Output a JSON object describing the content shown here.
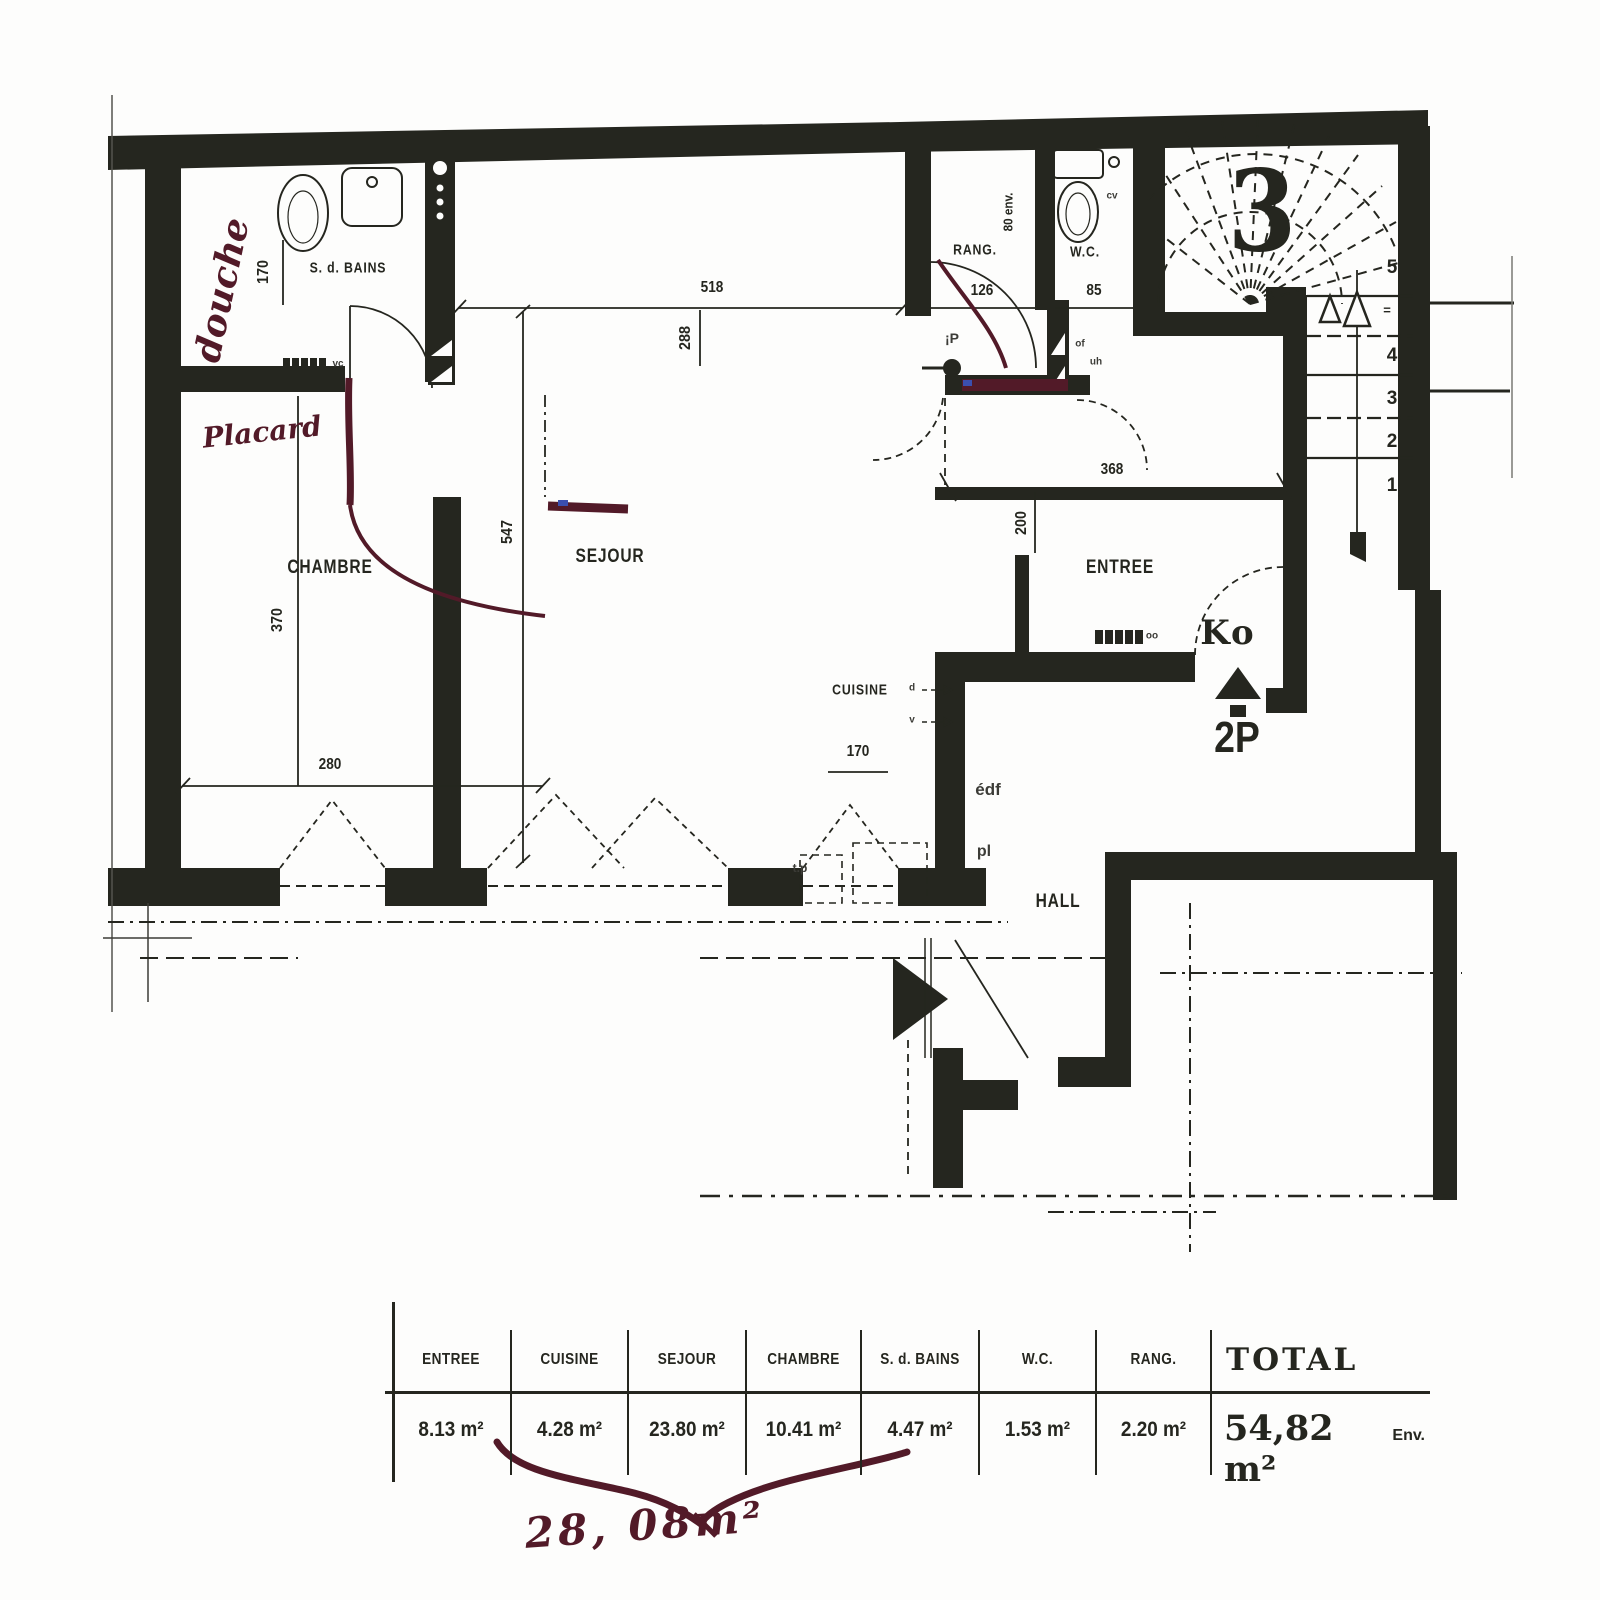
{
  "colors": {
    "ink": "#25261f",
    "annotation": "#521a28",
    "paper": "#fdfdfc"
  },
  "plan": {
    "floor_number": "3",
    "unit_code": "Ko",
    "unit_type": "2P",
    "rooms": {
      "bathroom": "S. d. BAINS",
      "bedroom": "CHAMBRE",
      "living": "SEJOUR",
      "kitchen": "CUISINE",
      "entry": "ENTREE",
      "storage": "RANG.",
      "wc": "W.C.",
      "hall": "HALL"
    },
    "dimensions": {
      "d518": "518",
      "d288": "288",
      "d547": "547",
      "d370": "370",
      "d280": "280",
      "d126": "126",
      "d85": "85",
      "d80": "80 env.",
      "d368": "368",
      "d200": "200",
      "d170_bath": "170",
      "d170_kitchen": "170"
    },
    "stairs": {
      "steps": [
        "5",
        "4",
        "3",
        "2",
        "1"
      ],
      "dots": "="
    },
    "handwritten": {
      "shower": "douche",
      "closet": "Placard",
      "area_sum": "28, 08m²"
    },
    "small_marks": {
      "vc": "vc",
      "edf": "édf",
      "pl": "pl",
      "cv": "cv",
      "oo": "oo",
      "p_mark": "¡P",
      "of": "of",
      "uh": "uh",
      "tp": "t.p",
      "kitchen_d": "d",
      "kitchen_v": "v"
    }
  },
  "table": {
    "columns": [
      {
        "label": "ENTREE",
        "value": "8.13 m²"
      },
      {
        "label": "CUISINE",
        "value": "4.28 m²"
      },
      {
        "label": "SEJOUR",
        "value": "23.80 m²"
      },
      {
        "label": "CHAMBRE",
        "value": "10.41 m²"
      },
      {
        "label": "S. d. BAINS",
        "value": "4.47 m²"
      },
      {
        "label": "W.C.",
        "value": "1.53 m²"
      },
      {
        "label": "RANG.",
        "value": "2.20 m²"
      }
    ],
    "total": {
      "label": "TOTAL",
      "value": "54,82 m²",
      "suffix": "Env."
    }
  }
}
